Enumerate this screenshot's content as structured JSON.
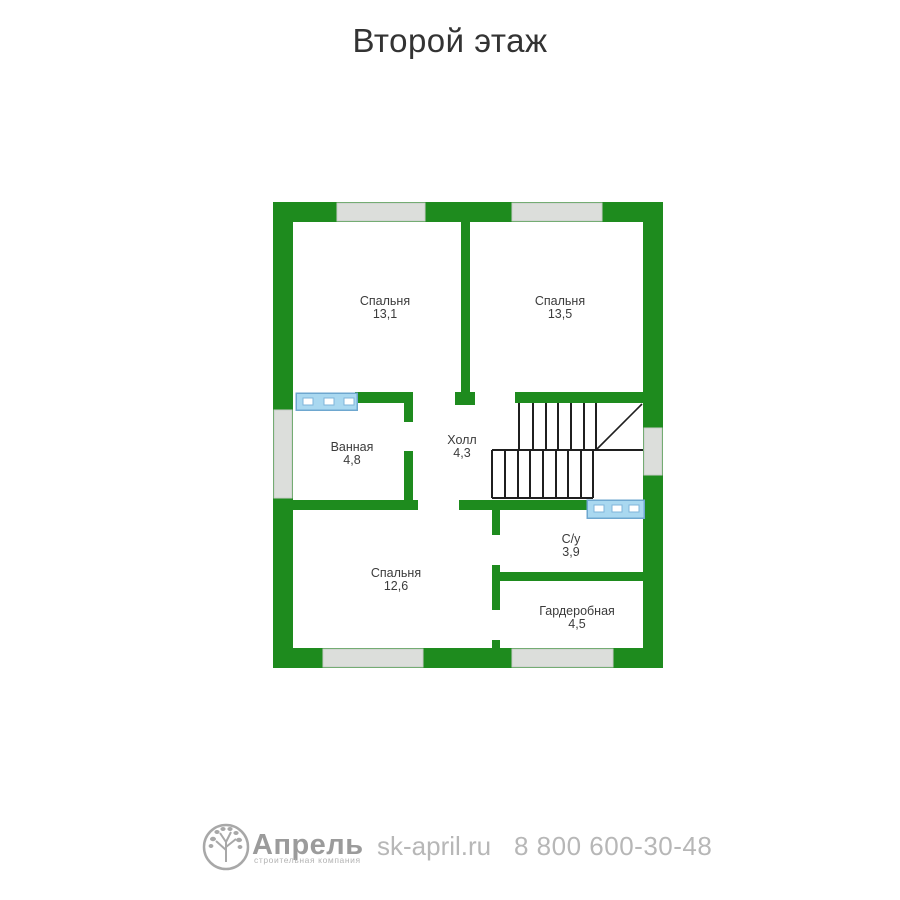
{
  "title": "Второй этаж",
  "plan": {
    "rooms": [
      {
        "name": "Спальня",
        "area": "13,1"
      },
      {
        "name": "Спальня",
        "area": "13,5"
      },
      {
        "name": "Ванная",
        "area": "4,8"
      },
      {
        "name": "Холл",
        "area": "4,3"
      },
      {
        "name": "С/у",
        "area": "3,9"
      },
      {
        "name": "Спальня",
        "area": "12,6"
      },
      {
        "name": "Гардеробная",
        "area": "4,5"
      }
    ]
  },
  "footer": {
    "logo_icon": "tree-in-circle-icon",
    "brand": "Апрель",
    "brand_subtitle": "строительная компания",
    "website": "sk-april.ru",
    "phone": "8 800 600-30-48"
  },
  "colors": {
    "wall_green": "#1e8b1e",
    "window_gray": "#dcdedb",
    "window_sill_blue": "#a9d8f0",
    "stairs_line": "#1f1f1f",
    "label_text": "#3b3b3b",
    "title_text": "#333333",
    "footer_gray": "#b7b7b7",
    "brand_gray": "#9b9b9b"
  }
}
